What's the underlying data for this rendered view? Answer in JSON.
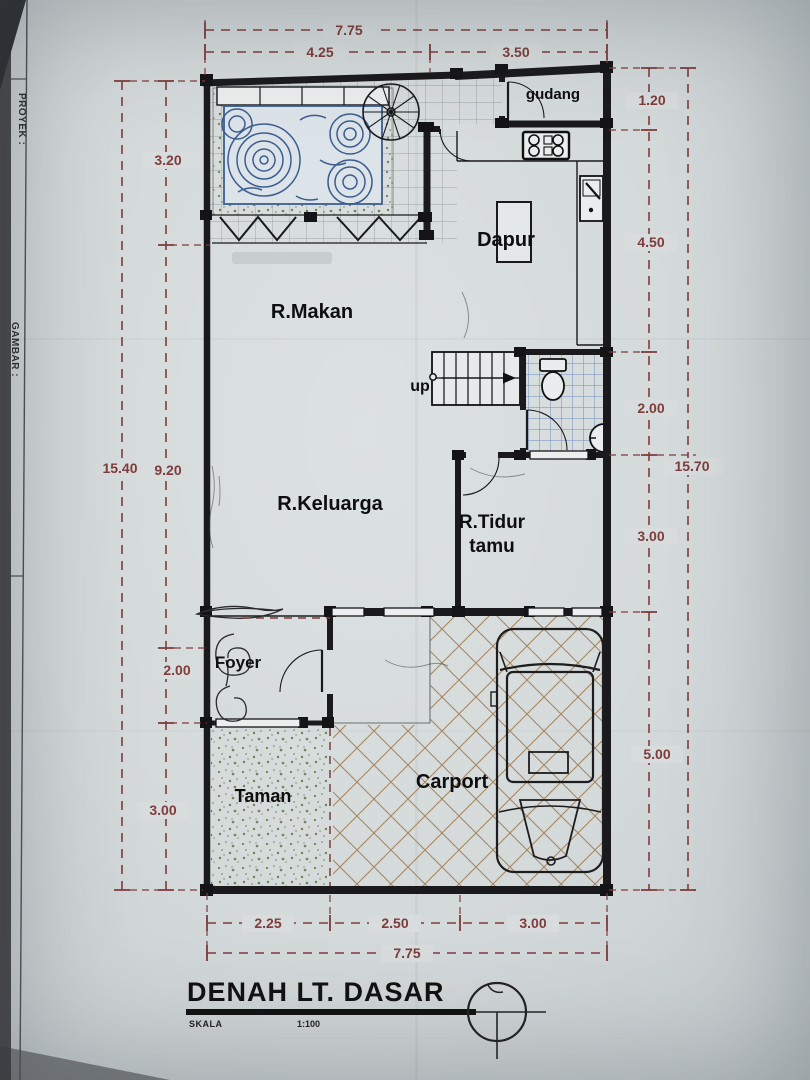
{
  "document": {
    "title": "DENAH LT. DASAR",
    "scale_label": "SKALA",
    "scale_value": "1:100"
  },
  "margin": {
    "proyek": "PROYEK :",
    "gambar": "GAMBAR :"
  },
  "rooms": {
    "gudang": "gudang",
    "dapur": "Dapur",
    "r_makan": "R.Makan",
    "up": "up",
    "r_keluarga": "R.Keluarga",
    "r_tidur_line1": "R.Tidur",
    "r_tidur_line2": "tamu",
    "foyer": "Foyer",
    "taman": "Taman",
    "carport": "Carport"
  },
  "dimensions": {
    "top": {
      "overall": "7.75",
      "left_span": "4.25",
      "right_span": "3.50"
    },
    "bottom": {
      "span1": "2.25",
      "span2": "2.50",
      "span3": "3.00",
      "overall": "7.75"
    },
    "left": {
      "overall": "15.40",
      "span1": "3.20",
      "span2": "9.20",
      "span3": "2.00",
      "span4": "3.00"
    },
    "right": {
      "span1": "1.20",
      "span2": "4.50",
      "span3": "2.00",
      "overall": "15.70",
      "span4": "3.00",
      "span5": "5.00"
    }
  },
  "colors": {
    "paper": "#d5dada",
    "wall": "#1a1a1c",
    "dimension": "#7e3c3c",
    "pond_blue": "#3c5e8f",
    "garden_green": "#71824f",
    "carport_hatch": "#a5835c",
    "bath_tile_blue": "#6d8abd"
  }
}
